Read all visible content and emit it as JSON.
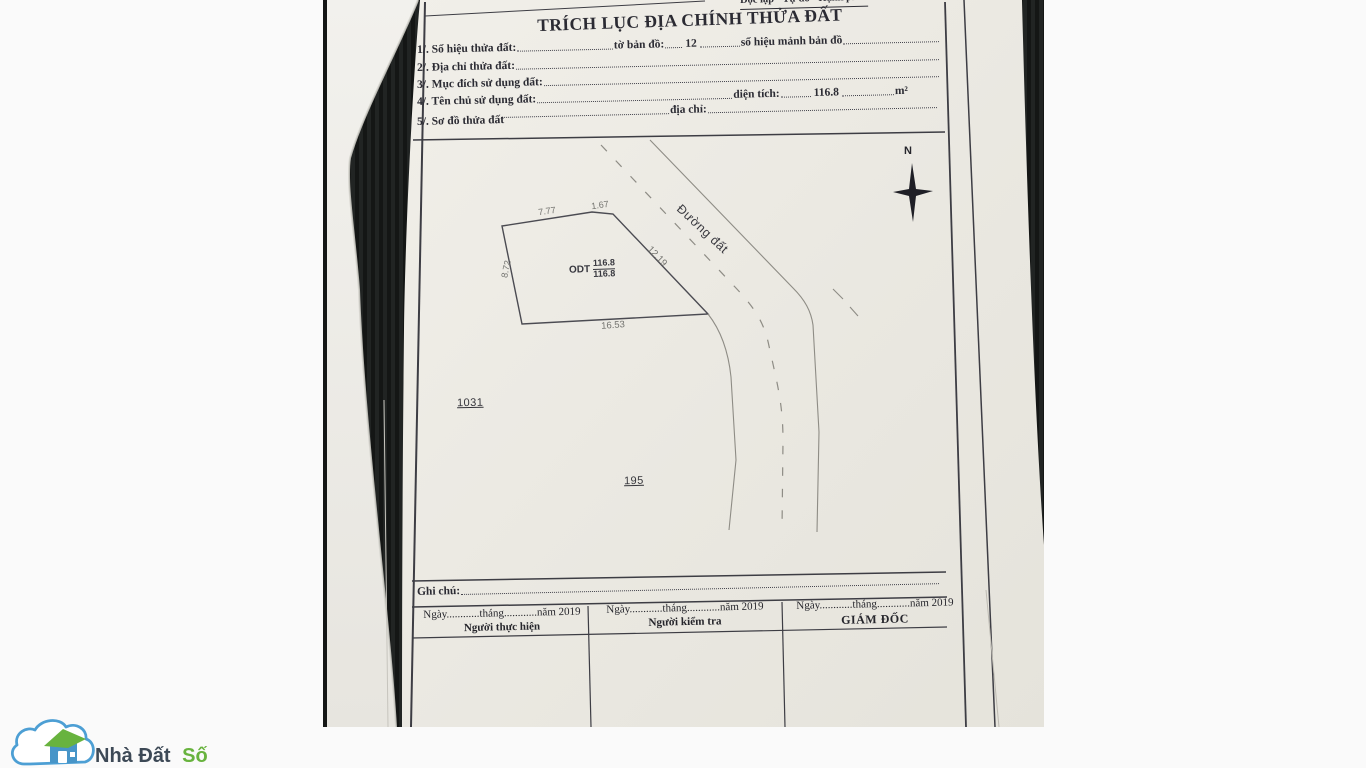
{
  "document": {
    "motto": "Độc lập - Tự do - Hạnh phúc",
    "title": "TRÍCH LỤC ĐỊA CHÍNH THỬA ĐẤT",
    "fields": {
      "f1": {
        "label": "1/. Số hiệu thửa đất:",
        "mid": "tờ bản đồ:",
        "value": "12",
        "tail": "số hiệu mảnh bản đồ"
      },
      "f2": {
        "label": "2/. Địa chỉ thửa đất:"
      },
      "f3": {
        "label": "3/. Mục đích sử dụng đất:"
      },
      "f4": {
        "label": "4/. Tên chủ sử dụng đất:",
        "area_label": "diện tích:",
        "area_value": "116.8",
        "area_unit": "m²",
        "addr_label": "địa chỉ:"
      },
      "f5": {
        "label": "5/. Sơ đồ thửa đất"
      }
    },
    "map": {
      "compass_label": "N",
      "road_label": "Đường đất",
      "parcel": {
        "code": "ODT",
        "area_numerator": "116.8",
        "area_denominator": "116.8",
        "edge_top": "7.77",
        "edge_top_small": "1.67",
        "edge_left": "8.72",
        "edge_bottom": "16.53",
        "edge_right": "12.19"
      },
      "adjacent_parcels": [
        "1031",
        "195"
      ]
    },
    "notes_label": "Ghi chú:",
    "signature_table": {
      "columns": [
        {
          "date_line": "Ngày............tháng............năm 2019",
          "role": "Người thực hiện"
        },
        {
          "date_line": "Ngày............tháng............năm 2019",
          "role": "Người kiểm tra"
        },
        {
          "date_line": "Ngày............tháng............năm 2019",
          "role": "GIÁM ĐỐC"
        }
      ]
    }
  },
  "watermark": {
    "brand_first": "Nhà Đất",
    "brand_accent": "Số"
  },
  "colors": {
    "paper": "#ece9e3",
    "ink": "#2b2b33",
    "photo_background": "#1b1d1c",
    "brand_blue": "#4d9fd4",
    "brand_green": "#68b33e",
    "brand_dark": "#3d4956"
  }
}
